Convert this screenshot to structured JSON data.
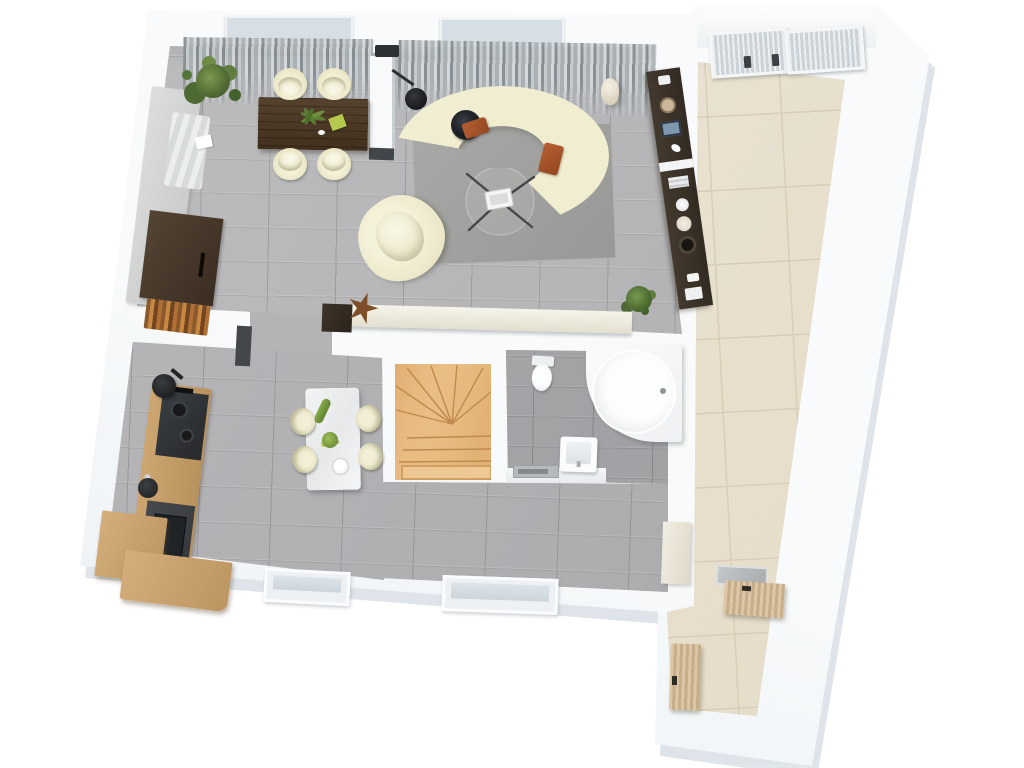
{
  "scene": {
    "kind": "3d-floor-plan-top-down-render",
    "canvas": {
      "width": 1024,
      "height": 768
    },
    "background": "#ffffff",
    "visible_text": []
  },
  "palette": {
    "outer_wall": "#f2f5f7",
    "building_shadow": "#ccd6dd",
    "floor_gray_tile": "#b6b6b8",
    "floor_gray_tile_dark": "#a6a6a9",
    "floor_beige_tile": "#ebe3d1",
    "beige_grout": "#d8ceb8",
    "stair_wood": "#e7bb80",
    "sofa_cream": "#f1edd0",
    "rug_gray": "#a4a4a2",
    "dining_table_walnut": "#4c3a26",
    "wall_unit_espresso": "#3a332b",
    "kitchen_counter_dark": "#3f4245",
    "cabinet_oak": "#c59e6e",
    "accent_rust_pillow": "#a9552d",
    "plant_green": "#55703a",
    "fixture_white": "#f7f8f9",
    "curtain_gray": "#a9b0b4",
    "skylight_gray": "#ccd3d8"
  },
  "rooms": [
    {
      "id": "living-dining-room",
      "floor": "gray plank tile",
      "position": "top-left"
    },
    {
      "id": "kitchen",
      "floor": "gray plank tile",
      "position": "bottom-left"
    },
    {
      "id": "hallway",
      "floor": "gray plank tile",
      "position": "bottom-center"
    },
    {
      "id": "bathroom",
      "floor": "gray tile",
      "position": "center-right",
      "fixtures": [
        "toilet",
        "round-corner-tub",
        "washbasin",
        "tray-shelf"
      ]
    },
    {
      "id": "staircase",
      "floor": "oak winder stairs",
      "position": "center"
    },
    {
      "id": "terrace-strip",
      "floor": "beige square tile",
      "position": "right",
      "features": [
        "two-skylights"
      ]
    },
    {
      "id": "entry-room",
      "floor": "beige square tile",
      "position": "bottom-right",
      "features": [
        "wood-cabinet",
        "wood-sideboard",
        "sink-top"
      ]
    }
  ],
  "furniture": {
    "living_dining": [
      "curved-sectional-sofa-cream",
      "gray-area-rug",
      "glass-coffee-table-with-magazines",
      "cream-armchair",
      "black-round-side-table",
      "black-arc-floor-lamp",
      "two-rust-pillows",
      "dark-wood-dining-table",
      "four-cream-tub-chairs",
      "fern-centerpiece",
      "lime-book",
      "gray-wall-bench-with-blanket",
      "dark-brown-fireplace-cabinet-with-firewood",
      "potted-plant-large",
      "potted-plant-small",
      "cream-floor-vase",
      "espresso-wall-unit-with-decor",
      "cream-low-ledge-sideboard",
      "starfish-decor"
    ],
    "kitchen": [
      "dark-cooktop-counter",
      "dark-sink-counter",
      "oak-cabinet-run",
      "oak-corner-blocks",
      "black-kettle",
      "black-pot",
      "marble-island",
      "four-cream-bar-chairs",
      "cucumber",
      "yellow-flowers",
      "white-bowl"
    ],
    "bathroom": [
      "toilet",
      "round-corner-tub",
      "washbasin",
      "gray-tray"
    ],
    "windows": [
      "top-window-left",
      "top-window-right",
      "skylight-left",
      "skylight-right",
      "bottom-window-left",
      "bottom-window-right"
    ],
    "curtains": [
      "gray-curtain-left-bay",
      "gray-curtain-right-bay"
    ]
  }
}
